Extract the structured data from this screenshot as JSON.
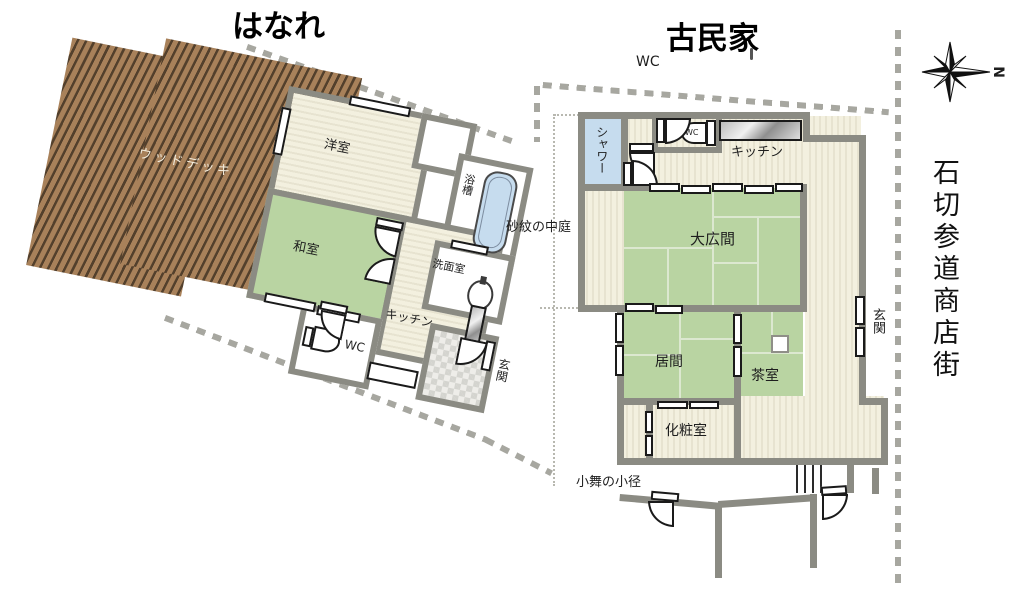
{
  "titles": {
    "hanare": "はなれ",
    "kominka": "古民家",
    "street": "石切参道商店街",
    "compass_n": "N"
  },
  "site": {
    "wc_outside": "WC",
    "courtyard": "砂紋の中庭",
    "path": "小舞の小径"
  },
  "hanare": {
    "deck": "ウッドデッキ",
    "western_room": "洋室",
    "japanese_room": "和室",
    "bathtub": "浴槽",
    "washroom": "洗面室",
    "kitchen": "キッチン",
    "wc": "WC",
    "entrance": "玄関"
  },
  "kominka": {
    "shower": "シャワー",
    "wc": "WC",
    "kitchen": "キッチン",
    "great_hall": "大広間",
    "living": "居間",
    "tea_room": "茶室",
    "entrance": "玄関",
    "powder_room": "化粧室"
  },
  "colors": {
    "wall": "#8b8b83",
    "tatami": "#b9d4a2",
    "floor_cream": "#f3f0df",
    "deck": "#a8815a",
    "deck_stripe": "#53402c",
    "shower_blue": "#c6dcee",
    "boundary": "#a7a7a0"
  }
}
